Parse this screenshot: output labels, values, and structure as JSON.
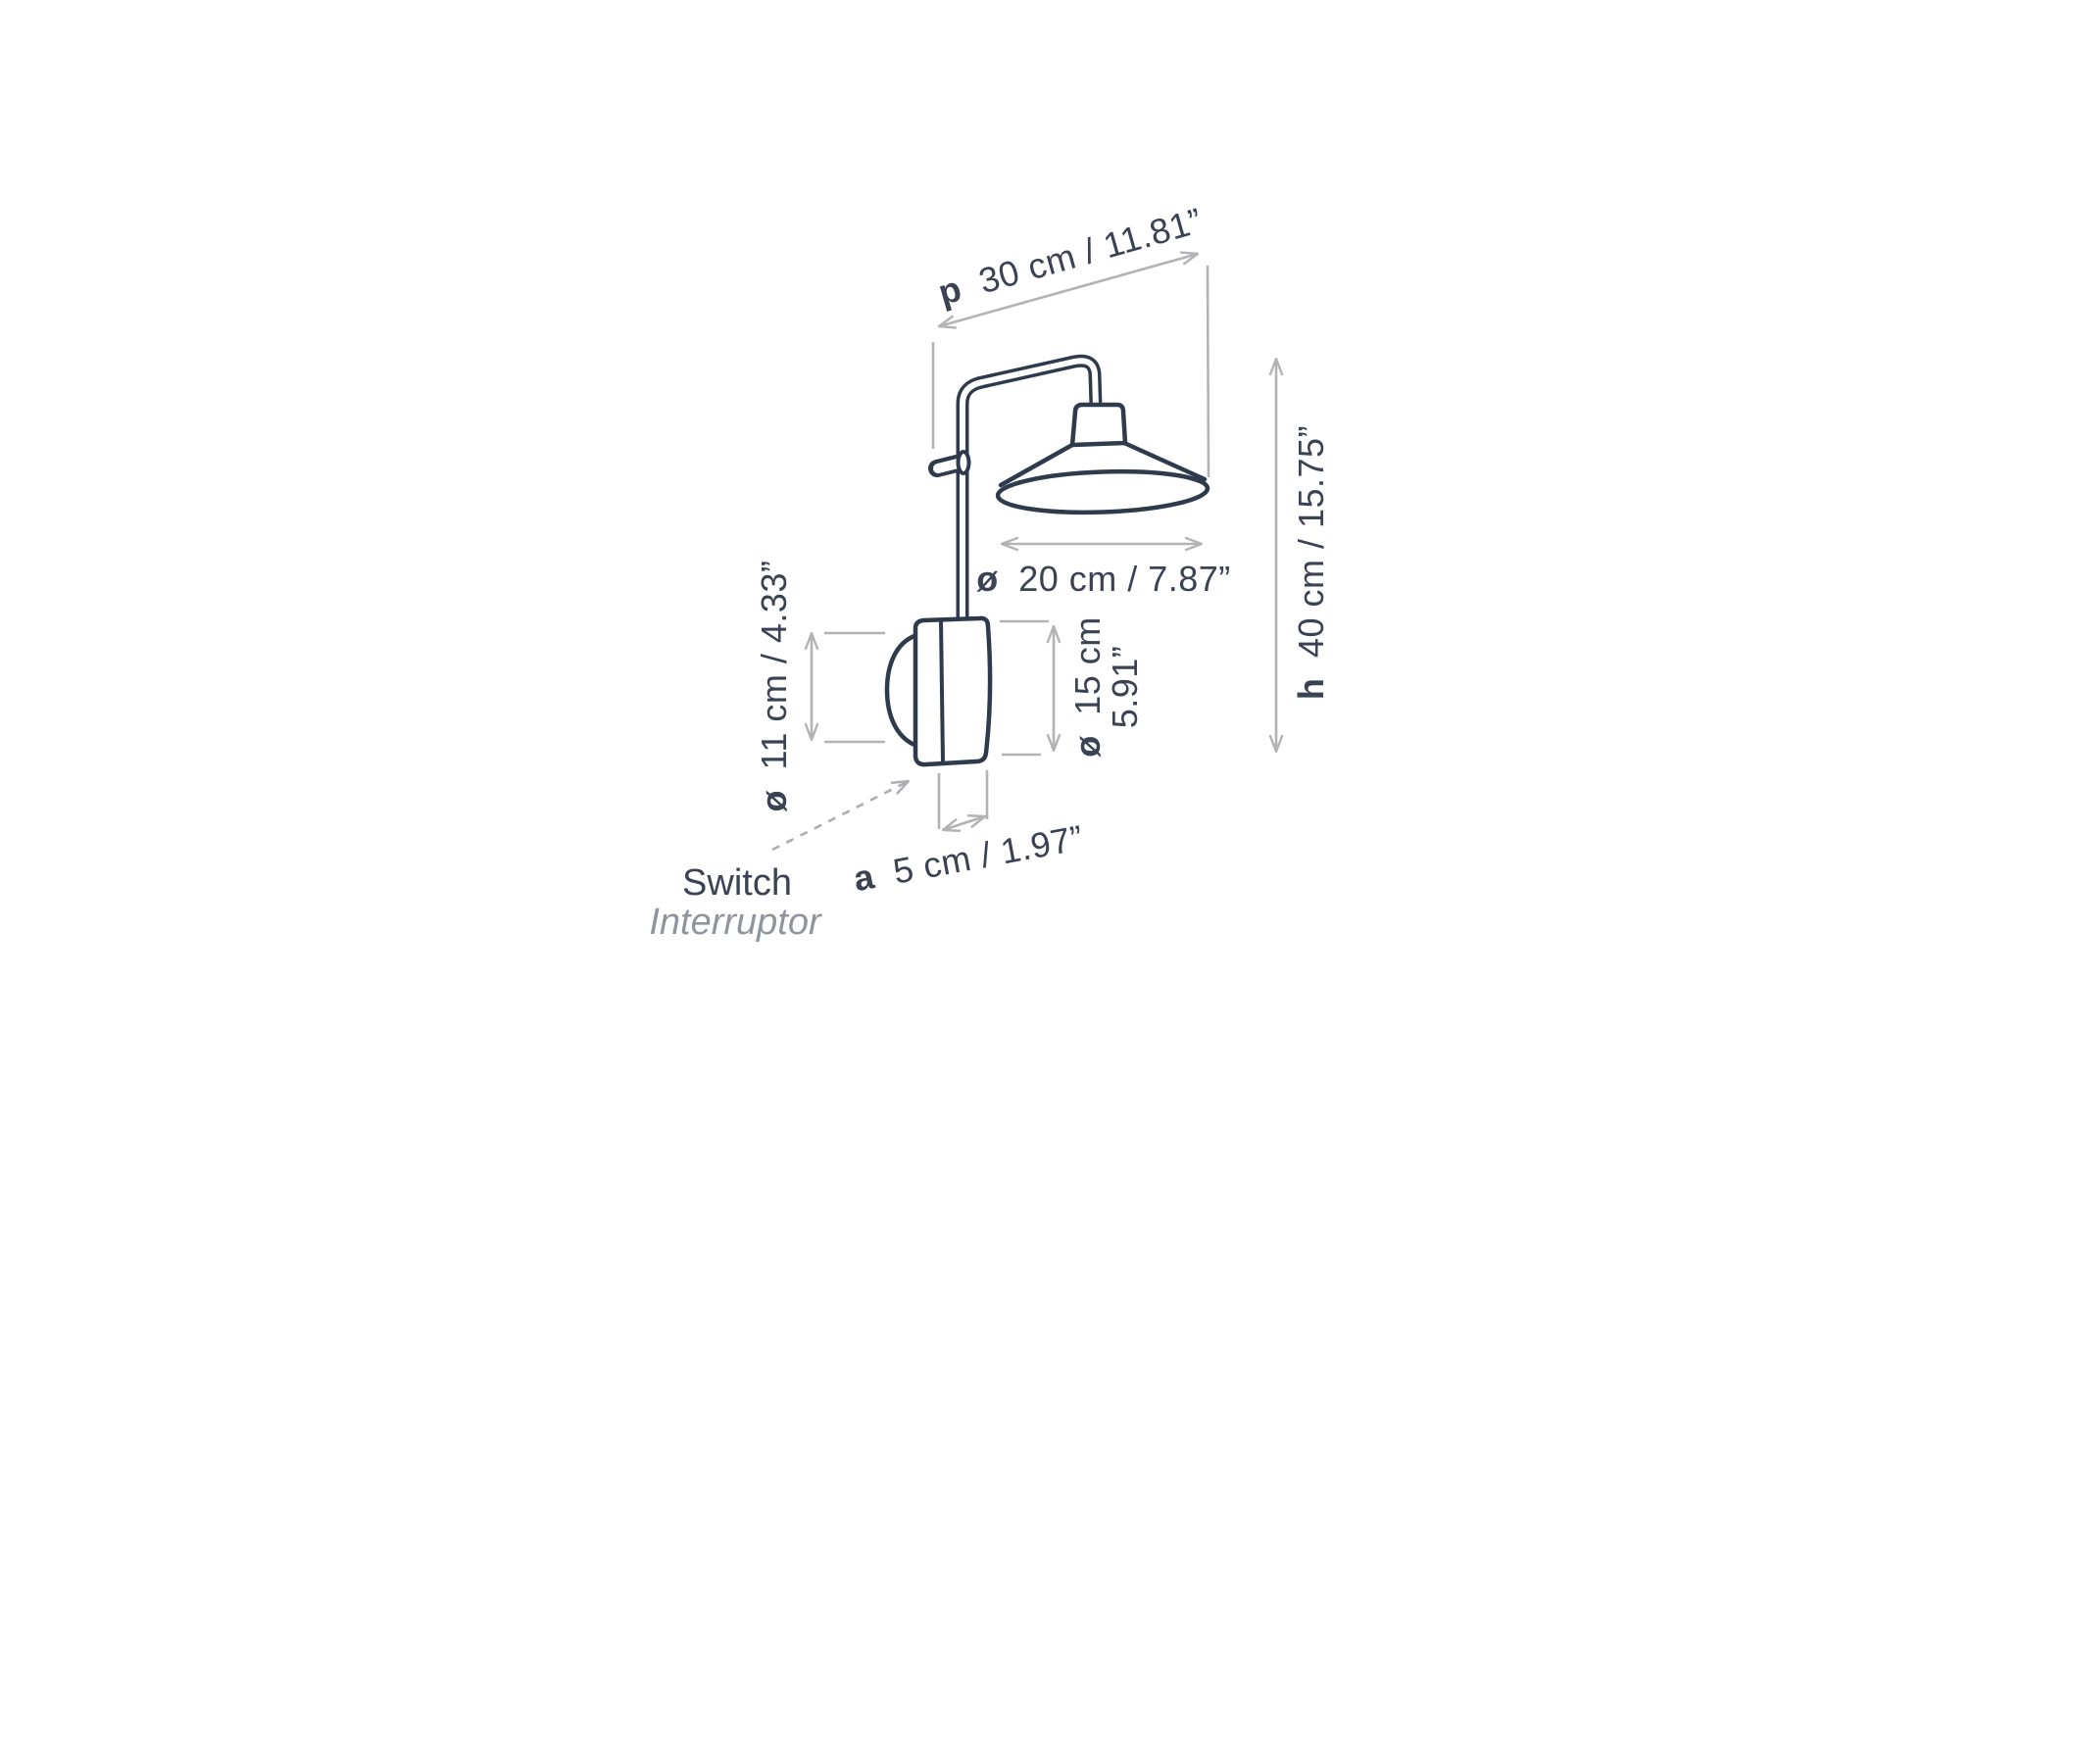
{
  "page": {
    "background": "#ffffff",
    "description": "Technical dimension drawing of a wall-mounted swing-arm lamp with metric and imperial measurements"
  },
  "colors": {
    "drawing_line": "#2f3b4c",
    "text": "#3a4254",
    "dimension_line": "#b3b3b6",
    "muted_text": "#8f959c"
  },
  "dimensions": {
    "depth": {
      "prefix": "p",
      "value": "30 cm / 11.81”"
    },
    "height": {
      "prefix": "h",
      "value": "40 cm / 15.75”"
    },
    "shade_diameter": {
      "prefix": "ø",
      "value": "20 cm / 7.87”"
    },
    "diffuser_diameter": {
      "prefix": "ø",
      "value": "11 cm / 4.33”"
    },
    "body_diameter": {
      "prefix": "ø",
      "value_line1": "15 cm",
      "value_line2": "5.91”"
    },
    "wall_offset": {
      "prefix": "a",
      "value": "5 cm / 1.97”"
    }
  },
  "labels": {
    "switch_en": "Switch",
    "switch_es": "Interruptor"
  }
}
